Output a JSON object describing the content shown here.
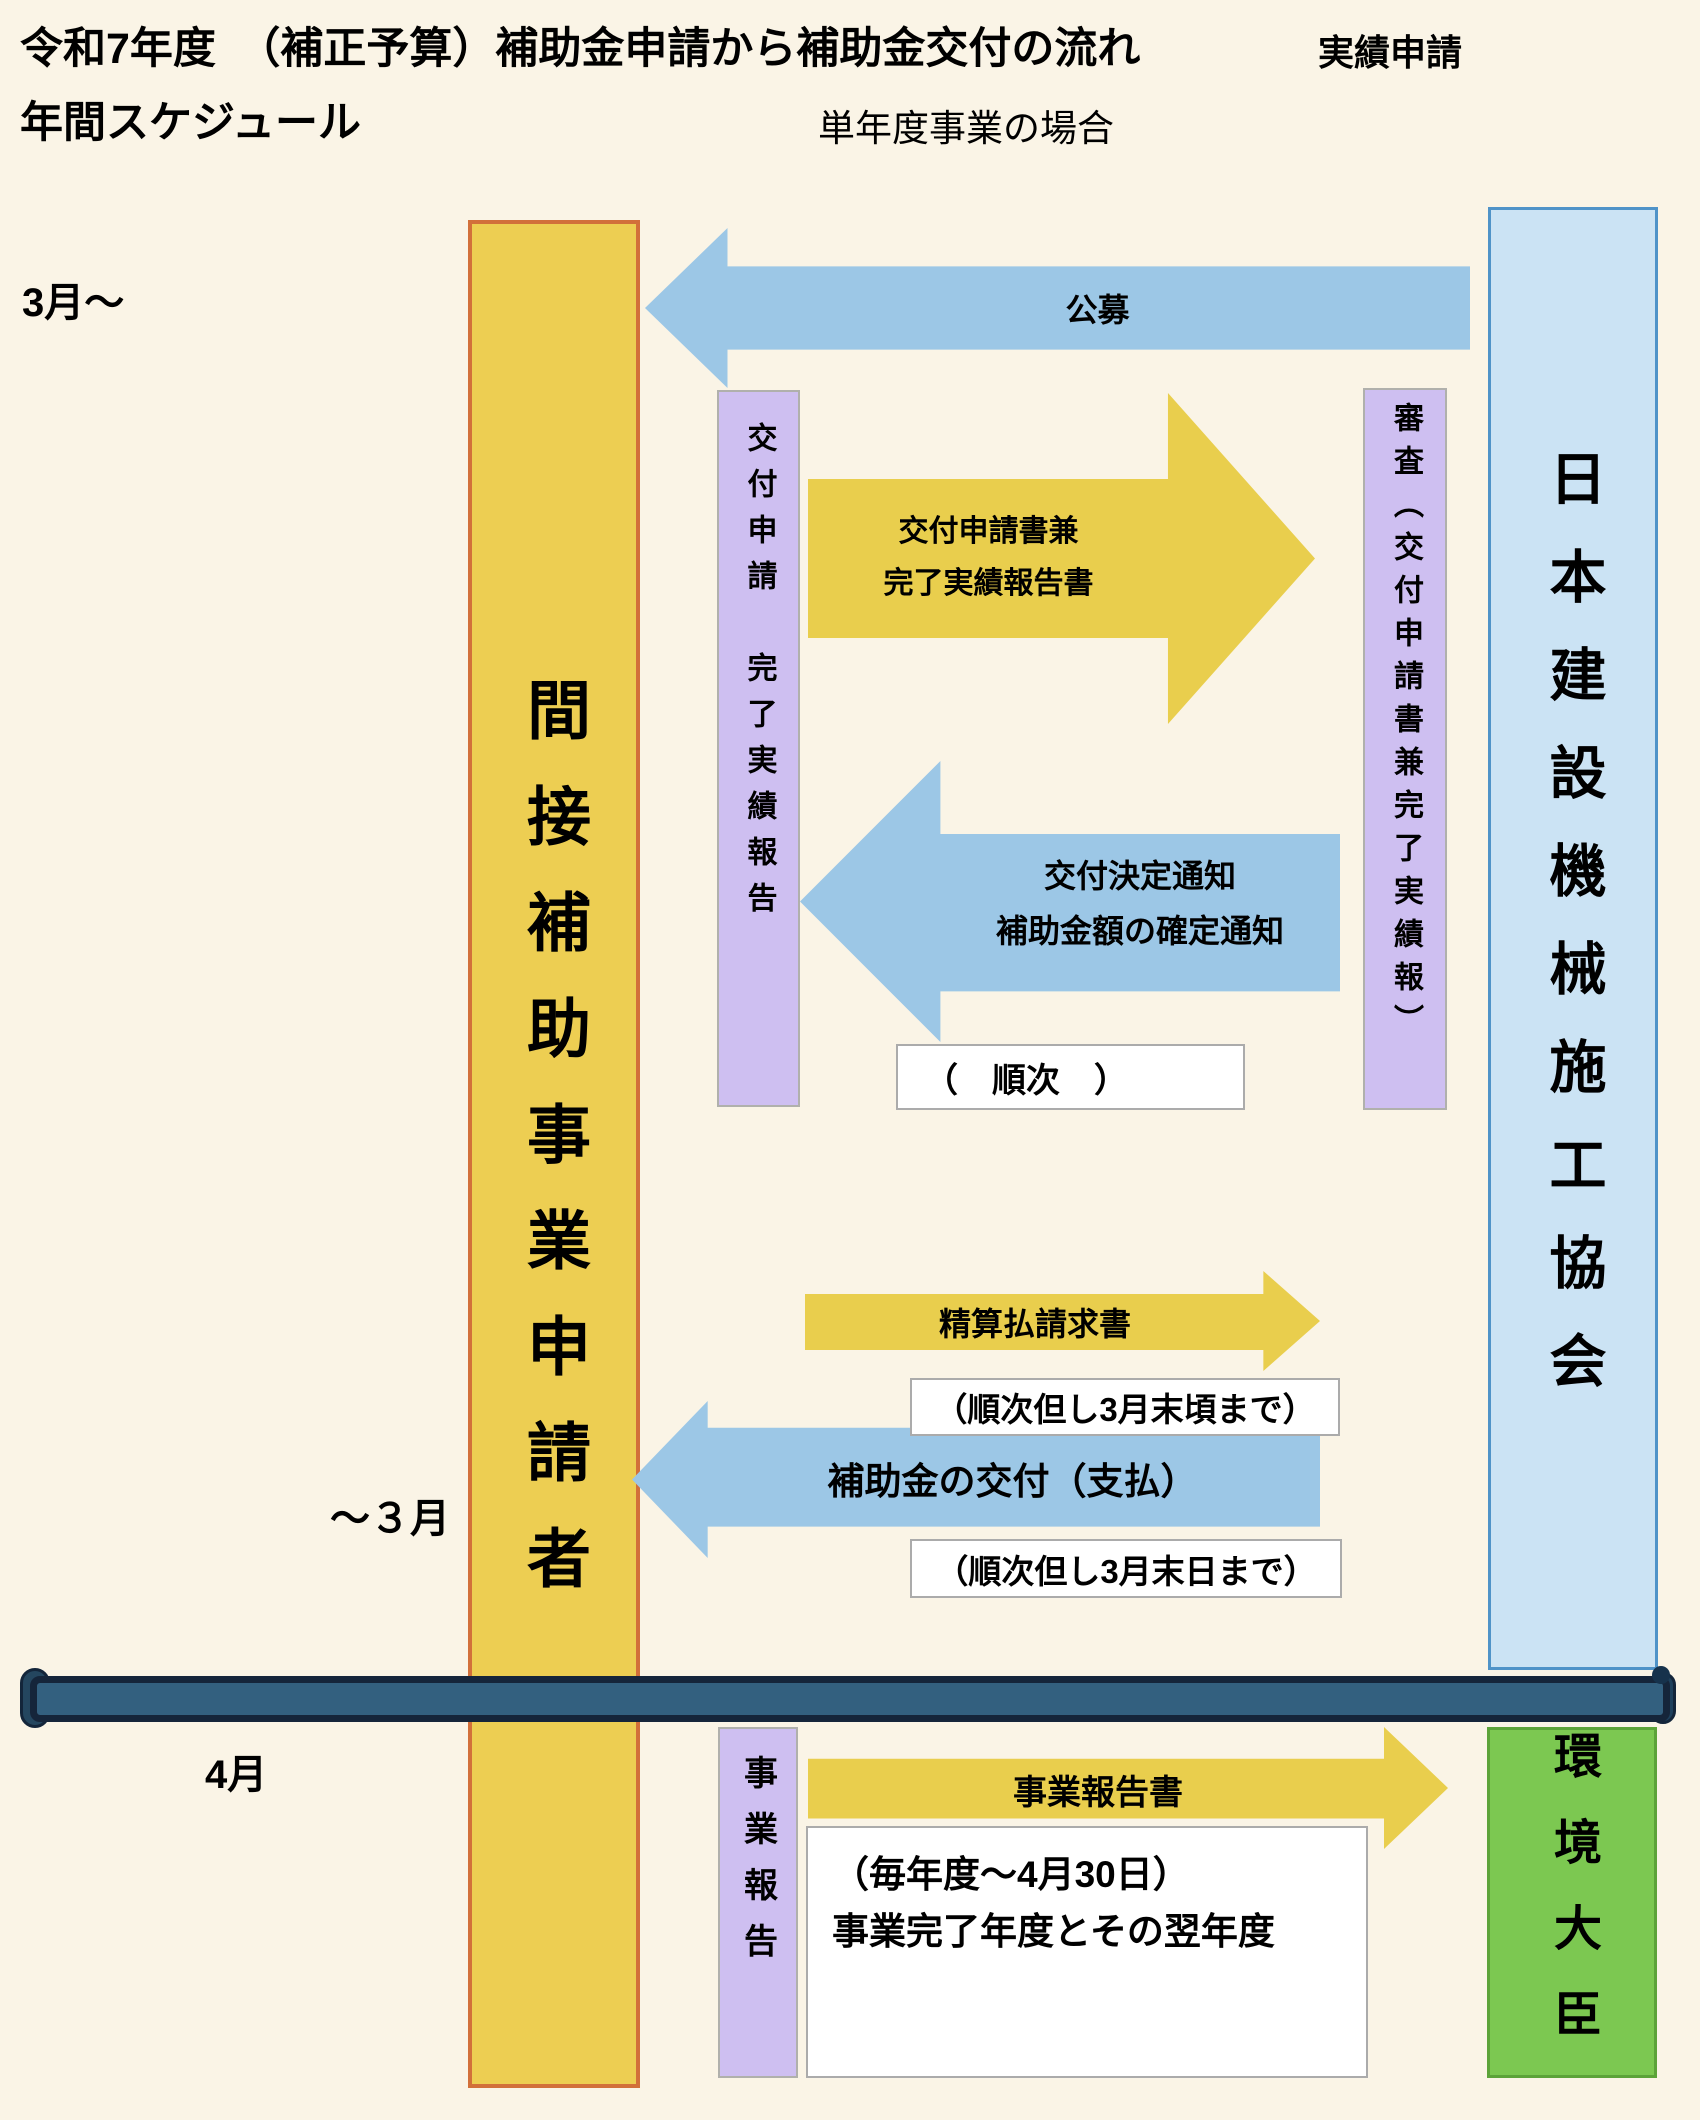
{
  "slide": {
    "title_line1": "令和7年度　（補正予算）補助金申請から補助金交付の流れ",
    "title_annotation": "実績申請",
    "title_line2": "年間スケジュール",
    "subtitle": "単年度事業の場合"
  },
  "timeline_labels": {
    "march_start": "3月～",
    "march_end": "～３月",
    "april": "4月"
  },
  "actors": {
    "applicant": "間接補助事業申請者",
    "association": "日本建設機械施工協会",
    "minister": "環境大臣"
  },
  "process_bars": {
    "application": "交付申請　完了実績報告",
    "review": "審査（交付申請書兼完了実績報）",
    "business_report": "事業報告"
  },
  "arrows": {
    "kobo": {
      "label": "公募",
      "direction": "left"
    },
    "application_docs": {
      "line1": "交付申請書兼",
      "line2": "完了実績報告書",
      "direction": "right"
    },
    "grant_decision": {
      "line1": "交付決定通知",
      "line2": "補助金額の確定通知",
      "direction": "left"
    },
    "settlement_invoice": {
      "label": "精算払請求書",
      "direction": "right"
    },
    "subsidy_payment": {
      "label": "補助金の交付（支払）",
      "direction": "left"
    },
    "business_report_doc": {
      "label": "事業報告書",
      "direction": "right"
    }
  },
  "notes": {
    "sequential": "（　順次　）",
    "sequential_march_late": "（順次但し3月末頃まで）",
    "sequential_march_end": "（順次但し3月末日まで）",
    "report_deadline_line1": "（毎年度～4月30日）",
    "report_deadline_line2": "事業完了年度とその翌年度"
  },
  "colors": {
    "background": "#FAF4E6",
    "applicant_bar_fill": "#EDCE52",
    "applicant_bar_border": "#D2703A",
    "association_bar_fill": "#CBE3F4",
    "association_bar_border": "#4F93C8",
    "minister_bar_fill": "#7CC851",
    "minister_bar_border": "#5CA339",
    "process_bar_fill": "#CEBFF1",
    "process_bar_border": "#B0B0AC",
    "blue_arrow": "#9CC7E6",
    "yellow_arrow": "#E9CE4D",
    "timeline_bar": "#33607F",
    "timeline_bar_edge": "#15253A"
  }
}
